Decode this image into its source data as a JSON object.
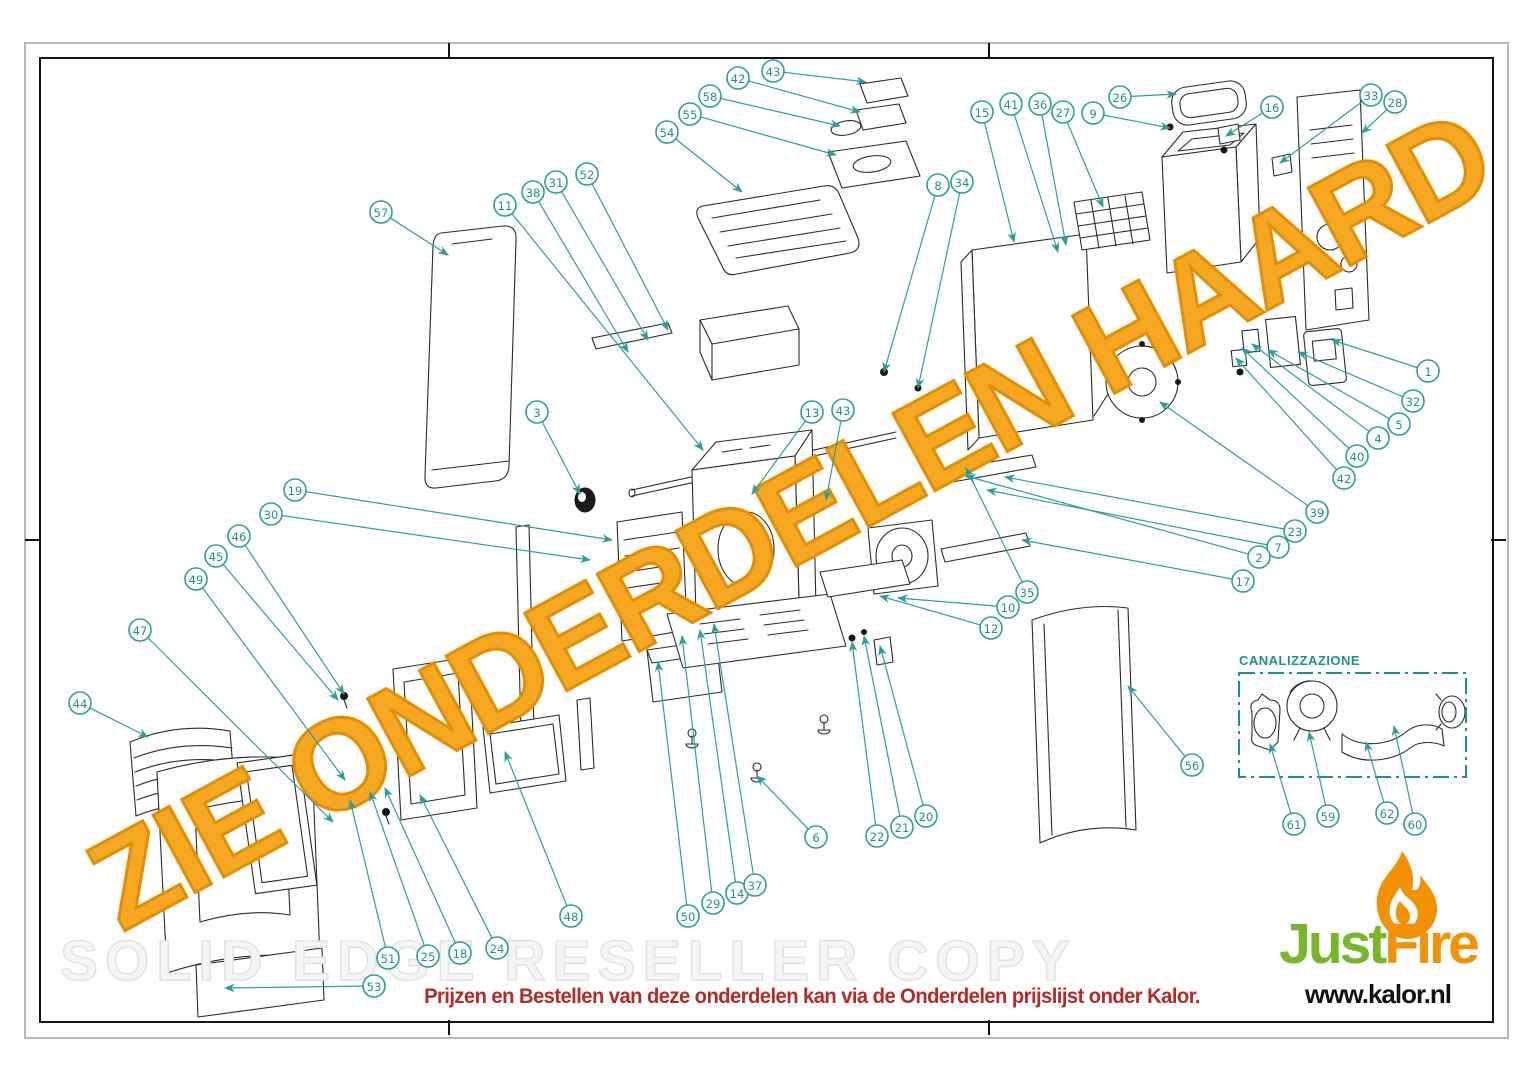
{
  "watermarks": {
    "diagonal": "ZIE ONDERDELEN HAARD",
    "background": "SOLID EDGE RESELLER COPY"
  },
  "inset": {
    "label": "CANALIZZAZIONE"
  },
  "footer": {
    "note": "Prijzen en Bestellen van deze onderdelen kan via de Onderdelen prijslijst onder Kalor."
  },
  "logo": {
    "word_part1": "Just",
    "word_part2": "Fire",
    "website": "www.kalor.nl"
  },
  "colors": {
    "callout_teal": "#2b9e9e",
    "watermark_orange": "#F5A71F",
    "watermark_orange_stroke": "#E28F05",
    "footer_red": "#B32B27",
    "logo_green": "#76B82A",
    "logo_orange": "#F39200",
    "inset_teal": "#1d8f8f",
    "line_black": "#2b2b2b"
  },
  "callouts": [
    {
      "label": "57",
      "x": 381,
      "y": 212,
      "tx": 448,
      "ty": 255
    },
    {
      "label": "11",
      "x": 505,
      "y": 205,
      "tx": 703,
      "ty": 450
    },
    {
      "label": "38",
      "x": 533,
      "y": 192,
      "tx": 628,
      "ty": 352
    },
    {
      "label": "31",
      "x": 556,
      "y": 182,
      "tx": 648,
      "ty": 340
    },
    {
      "label": "52",
      "x": 587,
      "y": 174,
      "tx": 668,
      "ty": 330
    },
    {
      "label": "54",
      "x": 667,
      "y": 132,
      "tx": 742,
      "ty": 192
    },
    {
      "label": "55",
      "x": 690,
      "y": 114,
      "tx": 836,
      "ty": 155
    },
    {
      "label": "58",
      "x": 710,
      "y": 96,
      "tx": 840,
      "ty": 126
    },
    {
      "label": "42",
      "x": 738,
      "y": 78,
      "tx": 860,
      "ty": 112
    },
    {
      "label": "43",
      "x": 773,
      "y": 71,
      "tx": 866,
      "ty": 82
    },
    {
      "label": "15",
      "x": 982,
      "y": 112,
      "tx": 1014,
      "ty": 242
    },
    {
      "label": "41",
      "x": 1011,
      "y": 104,
      "tx": 1058,
      "ty": 252
    },
    {
      "label": "36",
      "x": 1040,
      "y": 104,
      "tx": 1066,
      "ty": 245
    },
    {
      "label": "27",
      "x": 1063,
      "y": 112,
      "tx": 1103,
      "ty": 207
    },
    {
      "label": "9",
      "x": 1093,
      "y": 113,
      "tx": 1170,
      "ty": 128
    },
    {
      "label": "26",
      "x": 1120,
      "y": 97,
      "tx": 1176,
      "ty": 94
    },
    {
      "label": "16",
      "x": 1272,
      "y": 107,
      "tx": 1226,
      "ty": 136
    },
    {
      "label": "33",
      "x": 1371,
      "y": 95,
      "tx": 1280,
      "ty": 163
    },
    {
      "label": "28",
      "x": 1395,
      "y": 102,
      "tx": 1362,
      "ty": 133
    },
    {
      "label": "8",
      "x": 938,
      "y": 185,
      "tx": 884,
      "ty": 372
    },
    {
      "label": "34",
      "x": 962,
      "y": 182,
      "tx": 918,
      "ty": 388
    },
    {
      "label": "1",
      "x": 1428,
      "y": 371,
      "tx": 1332,
      "ty": 340
    },
    {
      "label": "32",
      "x": 1413,
      "y": 401,
      "tx": 1298,
      "ty": 352
    },
    {
      "label": "5",
      "x": 1399,
      "y": 424,
      "tx": 1268,
      "ty": 350
    },
    {
      "label": "4",
      "x": 1378,
      "y": 438,
      "tx": 1252,
      "ty": 344
    },
    {
      "label": "40",
      "x": 1357,
      "y": 456,
      "tx": 1242,
      "ty": 348
    },
    {
      "label": "42",
      "x": 1344,
      "y": 478,
      "tx": 1236,
      "ty": 358
    },
    {
      "label": "39",
      "x": 1317,
      "y": 512,
      "tx": 1160,
      "ty": 402
    },
    {
      "label": "23",
      "x": 1295,
      "y": 531,
      "tx": 1005,
      "ty": 477
    },
    {
      "label": "7",
      "x": 1278,
      "y": 547,
      "tx": 987,
      "ty": 490
    },
    {
      "label": "2",
      "x": 1259,
      "y": 557,
      "tx": 966,
      "ty": 476
    },
    {
      "label": "17",
      "x": 1243,
      "y": 581,
      "tx": 1022,
      "ty": 540
    },
    {
      "label": "13",
      "x": 812,
      "y": 412,
      "tx": 752,
      "ty": 494
    },
    {
      "label": "43",
      "x": 843,
      "y": 410,
      "tx": 826,
      "ty": 500
    },
    {
      "label": "35",
      "x": 1027,
      "y": 592,
      "tx": 966,
      "ty": 468
    },
    {
      "label": "10",
      "x": 1008,
      "y": 607,
      "tx": 898,
      "ty": 598
    },
    {
      "label": "12",
      "x": 991,
      "y": 628,
      "tx": 880,
      "ty": 596
    },
    {
      "label": "3",
      "x": 537,
      "y": 412,
      "tx": 580,
      "ty": 494
    },
    {
      "label": "19",
      "x": 295,
      "y": 490,
      "tx": 612,
      "ty": 540
    },
    {
      "label": "30",
      "x": 271,
      "y": 514,
      "tx": 590,
      "ty": 560
    },
    {
      "label": "46",
      "x": 239,
      "y": 536,
      "tx": 344,
      "ty": 694
    },
    {
      "label": "45",
      "x": 216,
      "y": 556,
      "tx": 338,
      "ty": 700
    },
    {
      "label": "49",
      "x": 196,
      "y": 579,
      "tx": 345,
      "ty": 780
    },
    {
      "label": "47",
      "x": 140,
      "y": 630,
      "tx": 333,
      "ty": 822
    },
    {
      "label": "44",
      "x": 80,
      "y": 703,
      "tx": 148,
      "ty": 737
    },
    {
      "label": "51",
      "x": 388,
      "y": 958,
      "tx": 350,
      "ty": 800
    },
    {
      "label": "25",
      "x": 428,
      "y": 956,
      "tx": 370,
      "ty": 792
    },
    {
      "label": "18",
      "x": 460,
      "y": 953,
      "tx": 385,
      "ty": 788
    },
    {
      "label": "24",
      "x": 497,
      "y": 948,
      "tx": 420,
      "ty": 795
    },
    {
      "label": "53",
      "x": 374,
      "y": 986,
      "tx": 225,
      "ty": 988
    },
    {
      "label": "48",
      "x": 571,
      "y": 916,
      "tx": 505,
      "ty": 752
    },
    {
      "label": "50",
      "x": 688,
      "y": 916,
      "tx": 658,
      "ty": 662
    },
    {
      "label": "29",
      "x": 713,
      "y": 903,
      "tx": 682,
      "ty": 636
    },
    {
      "label": "14",
      "x": 737,
      "y": 893,
      "tx": 700,
      "ty": 630
    },
    {
      "label": "37",
      "x": 755,
      "y": 885,
      "tx": 714,
      "ty": 624
    },
    {
      "label": "6",
      "x": 816,
      "y": 837,
      "tx": 757,
      "ty": 776
    },
    {
      "label": "22",
      "x": 877,
      "y": 836,
      "tx": 852,
      "ty": 642
    },
    {
      "label": "21",
      "x": 902,
      "y": 827,
      "tx": 864,
      "ty": 636
    },
    {
      "label": "20",
      "x": 926,
      "y": 816,
      "tx": 880,
      "ty": 646
    },
    {
      "label": "56",
      "x": 1192,
      "y": 765,
      "tx": 1128,
      "ty": 686
    },
    {
      "label": "61",
      "x": 1294,
      "y": 824,
      "tx": 1270,
      "ty": 744
    },
    {
      "label": "59",
      "x": 1328,
      "y": 816,
      "tx": 1309,
      "ty": 732
    },
    {
      "label": "62",
      "x": 1387,
      "y": 813,
      "tx": 1366,
      "ty": 742
    },
    {
      "label": "60",
      "x": 1415,
      "y": 824,
      "tx": 1394,
      "ty": 726
    }
  ]
}
